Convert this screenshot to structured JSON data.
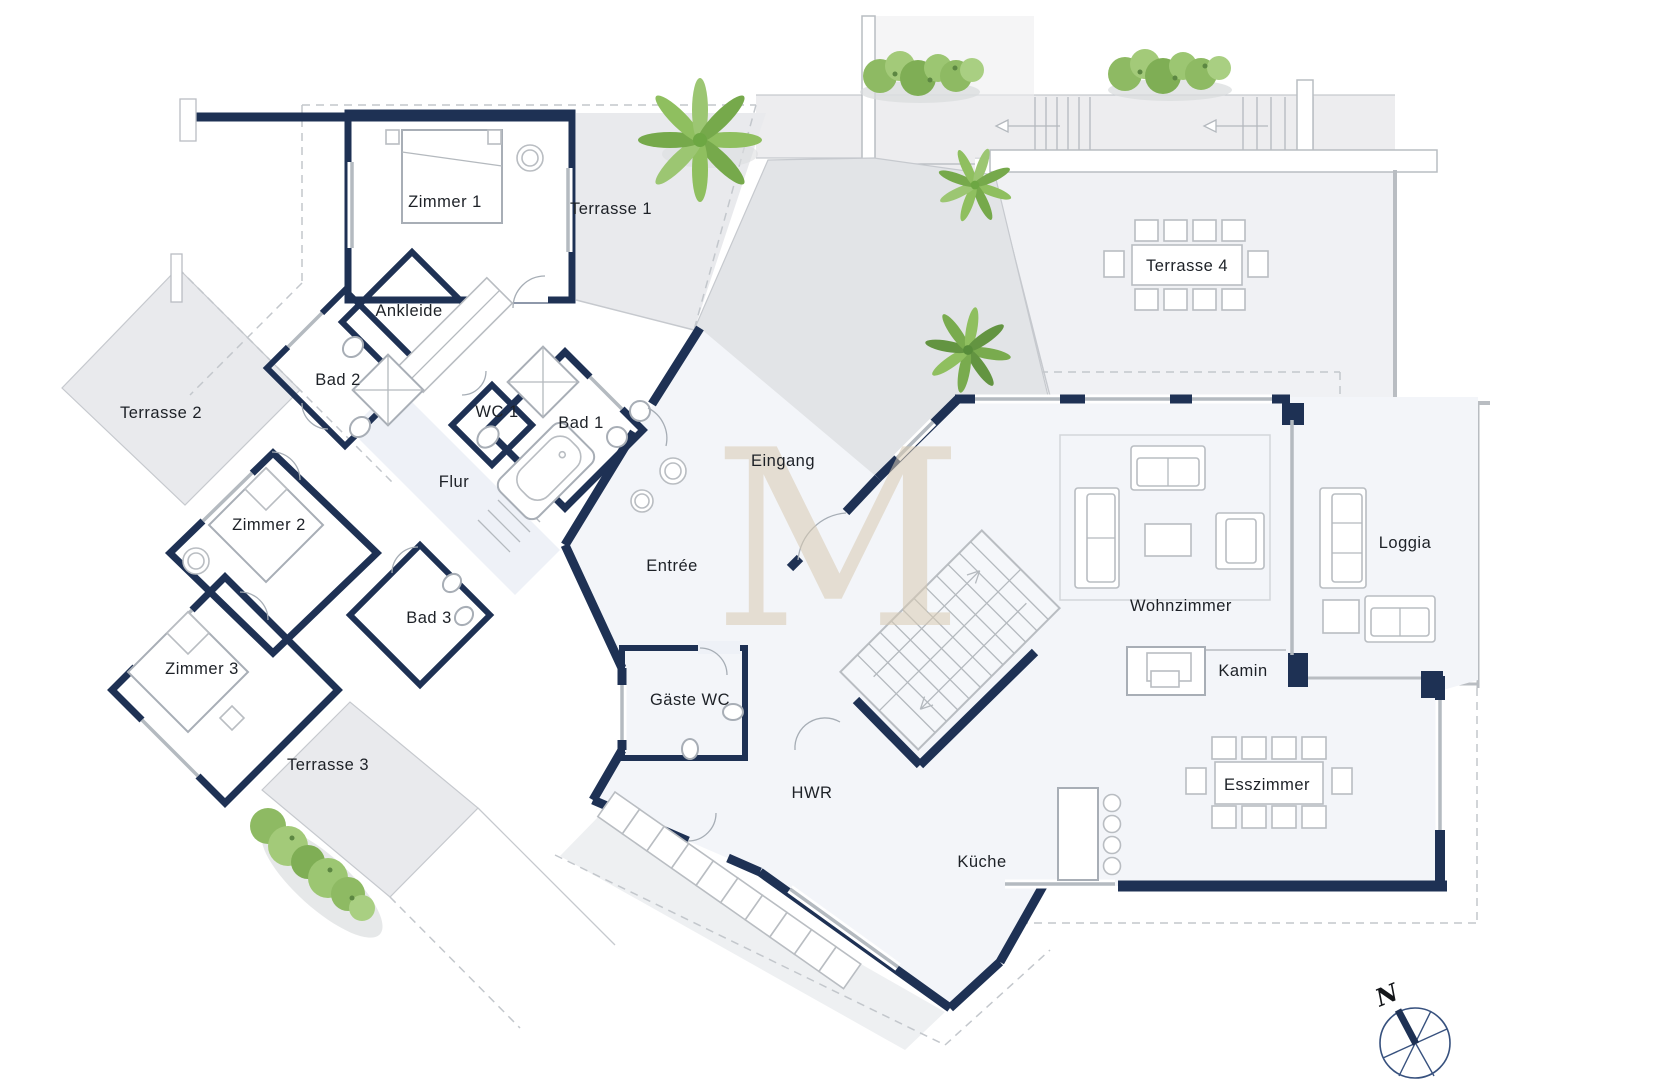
{
  "floorplan": {
    "rooms": {
      "zimmer1": "Zimmer 1",
      "ankleide": "Ankleide",
      "bad2": "Bad 2",
      "wc1": "WC 1",
      "bad1": "Bad 1",
      "flur": "Flur",
      "eingang": "Eingang",
      "zimmer2": "Zimmer 2",
      "entree": "Entrée",
      "bad3": "Bad 3",
      "zimmer3": "Zimmer 3",
      "gaeste_wc": "Gäste WC",
      "hwr": "HWR",
      "kueche": "Küche",
      "wohnzimmer": "Wohnzimmer",
      "kamin": "Kamin",
      "esszimmer": "Esszimmer",
      "loggia": "Loggia"
    },
    "terraces": {
      "terrasse1": "Terrasse 1",
      "terrasse2": "Terrasse 2",
      "terrasse3": "Terrasse 3",
      "terrasse4": "Terrasse 4"
    },
    "compass": {
      "north_label": "N"
    },
    "watermark": {
      "letter": "M"
    },
    "colors": {
      "wall": "#1e3154",
      "bedroom_fill": "#e8ecf5",
      "living_fill": "#f3f5f9",
      "terrace_fill": "#e9eaed",
      "plant_green": "#8fbf5f",
      "watermark_tan": "#d9cbb3"
    }
  }
}
